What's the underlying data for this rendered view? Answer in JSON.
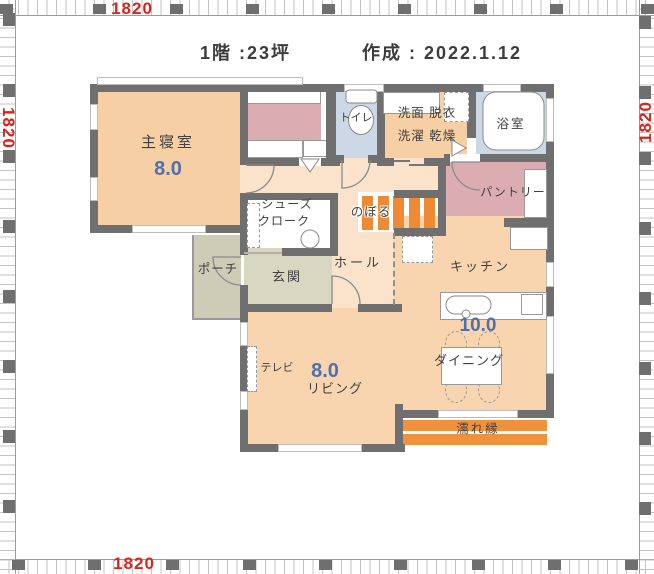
{
  "title": {
    "floor": "1階 :23坪",
    "created": "作成 : 2022.1.12"
  },
  "rulers": {
    "top": "1820",
    "bottom": "1820",
    "left": "1820",
    "right": "1820"
  },
  "rooms": {
    "bedroom": {
      "name": "主寝室",
      "size": "8.0"
    },
    "toilet": {
      "name": "トイレ"
    },
    "washroom": {
      "name_line1": "洗面 脱衣",
      "name_line2": "洗濯 乾燥"
    },
    "bath": {
      "name": "浴室"
    },
    "pantry": {
      "name": "パントリー"
    },
    "stairs": {
      "name": "のぼる"
    },
    "hall": {
      "name": "ホール"
    },
    "kitchen": {
      "name": "キッチン",
      "size": "10.0"
    },
    "dining": {
      "name": "ダイニング"
    },
    "living": {
      "name": "リビング",
      "size": "8.0"
    },
    "tv": {
      "label": "テレビ"
    },
    "shoe_closet": {
      "name_line1": "シューズ",
      "name_line2": "クローク"
    },
    "entrance": {
      "name": "玄関"
    },
    "porch": {
      "name": "ポーチ"
    },
    "engawa": {
      "name": "濡れ縁"
    }
  },
  "colors": {
    "wall": "#6f6f6f",
    "room_warm": "#f6cfa5",
    "room_warm_light": "#f8d5ae",
    "hall": "#fbe3cb",
    "wet_blue": "#ccd8e5",
    "closet_pink": "#dbadb3",
    "entrance_green": "#d8d7c2",
    "porch_green": "#cdccb6",
    "stairs_orange": "#ee8a34",
    "engawa_orange": "#ef923b",
    "dim_red": "#d6251d",
    "size_blue": "#5070ad",
    "text": "#404040"
  }
}
